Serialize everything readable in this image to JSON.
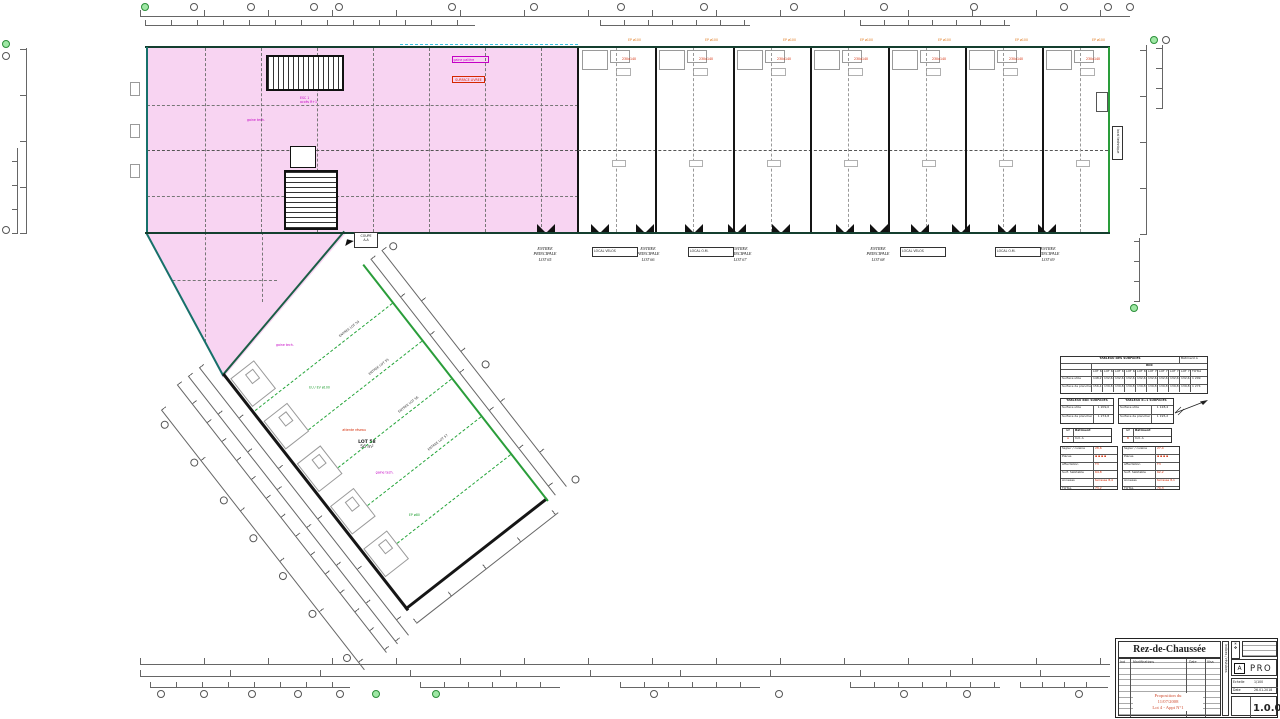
{
  "sheet": {
    "title": "Rez-de-Chaussée",
    "phase": "PRO",
    "revision": "A",
    "version": "1.0.0",
    "red_note": [
      "Proposition du",
      "11/07/2008",
      "Lot 4 - Appt N°1"
    ],
    "rev_headers": [
      "Ind",
      "Modifications",
      "Date",
      "Visa"
    ],
    "scale_label": "Echelle",
    "scale": "1/100",
    "date_label": "Date",
    "date": "26.01.2018",
    "side_label": "Indices / révisions"
  },
  "entrances": [
    {
      "l1": "ENTREE",
      "l2": "PRINCIPALE",
      "l3": "LOT 65"
    },
    {
      "l1": "ENTREE",
      "l2": "PRINCIPALE",
      "l3": "LOT 66"
    },
    {
      "l1": "ENTREE",
      "l2": "PRINCIPALE",
      "l3": "LOT 67"
    },
    {
      "l1": "ENTREE",
      "l2": "PRINCIPALE",
      "l3": "LOT 68"
    },
    {
      "l1": "ENTREE",
      "l2": "PRINCIPALE",
      "l3": "LOT 69"
    }
  ],
  "local_boxes": [
    "LOCAL VELOS",
    "LOCAL O.M.",
    "LOCAL VELOS",
    "LOCAL O.M."
  ],
  "labels": {
    "ep": "EP ø100",
    "unit_note": "230x140",
    "stair_note_1": "ESC 1",
    "stair_note_2": "accès R+1",
    "magenta_block_1": "gaine palière",
    "magenta_block_2": "gaine tech.",
    "red_box": "SURFACE LIVREE",
    "tech_room": "local technique",
    "tip_box_l1": "COUPE",
    "tip_box_l2": "A-A"
  },
  "wing": {
    "lot": "LOT 58",
    "area": "56 m²",
    "entr": [
      "ENTREE LOT 54",
      "ENTREE LOT 55",
      "ENTREE LOT 56",
      "ENTREE LOT 57"
    ],
    "notes": [
      {
        "text": "gaine tech.",
        "color": "mag"
      },
      {
        "text": "EU / EV ø100",
        "color": "grn"
      },
      {
        "text": "attente réseau",
        "color": "red"
      },
      {
        "text": "gaine tech.",
        "color": "mag"
      },
      {
        "text": "EP ø80",
        "color": "grn"
      }
    ]
  },
  "surfaces_table": {
    "title": "TABLEAU DES SURFACES",
    "corner": "Bâtiment A",
    "sub": "RDC",
    "cols": [
      "LOT 65",
      "LOT 66",
      "LOT 67",
      "LOT 68",
      "LOT 69",
      "LOT 70",
      "LOT 71",
      "LOT 72",
      "LOT 73",
      "TOTAL"
    ],
    "rows": [
      {
        "label": "Surface utile",
        "values": [
          "148,2",
          "132,6",
          "132,6",
          "132,6",
          "132,6",
          "132,6",
          "132,6",
          "132,6",
          "132,6",
          "1 209,0"
        ]
      },
      {
        "label": "Surface de plancher",
        "values": [
          "156,4",
          "139,8",
          "139,8",
          "139,8",
          "139,8",
          "139,8",
          "139,8",
          "139,8",
          "139,8",
          "1 274,8"
        ]
      }
    ]
  },
  "small_tables": [
    {
      "title": "TABLEAU RDC SURFACES",
      "rows": [
        [
          "Surface utile",
          "1 209,0"
        ],
        [
          "Surface de plancher",
          "1 274,8"
        ]
      ]
    },
    {
      "title": "TABLEAU R+1 SURFACES",
      "rows": [
        [
          "Surface utile",
          "1 128,4"
        ],
        [
          "Surface de plancher",
          "1 195,2"
        ]
      ]
    }
  ],
  "pair_boxes": [
    {
      "r1": [
        "GP",
        "Bâtiment"
      ],
      "r2": [
        "A",
        "Ind. A"
      ]
    },
    {
      "r1": [
        "GP",
        "Bâtiment"
      ],
      "r2": [
        "B",
        "Ind. A"
      ]
    }
  ],
  "cartouches": [
    {
      "rows": [
        [
          "Séjour / cuisine",
          "28,6"
        ],
        [
          "Pièces",
          "▪ ▪ ▪ ▪"
        ],
        [
          "Affectation",
          "T3"
        ],
        [
          "Surf. habitable",
          "64,8"
        ],
        [
          "Annexes",
          "terrasse 8,4"
        ],
        [
          "TOTAL",
          "73,2"
        ]
      ]
    },
    {
      "rows": [
        [
          "Séjour / cuisine",
          "27,4"
        ],
        [
          "Pièces",
          "▪ ▪ ▪ ▪"
        ],
        [
          "Affectation",
          "T3"
        ],
        [
          "Surf. habitable",
          "62,2"
        ],
        [
          "Annexes",
          "terrasse 8,1"
        ],
        [
          "TOTAL",
          "70,3"
        ]
      ]
    }
  ]
}
